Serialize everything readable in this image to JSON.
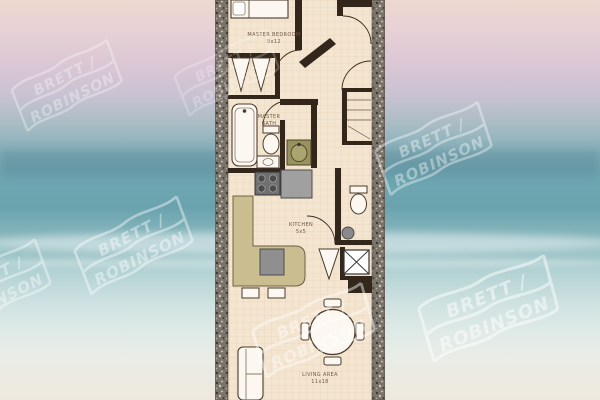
{
  "watermark": {
    "line1": "BRETT /",
    "line2": "ROBINSON",
    "color": "#ffffff"
  },
  "floor_plan": {
    "rooms": [
      {
        "name": "MASTER BEDROOM",
        "size": "9x12"
      },
      {
        "name": "MASTER BATH",
        "name_lines": [
          "MASTER",
          "BATH"
        ]
      },
      {
        "name": "KITCHEN",
        "size": "5x5"
      },
      {
        "name": "LIVING AREA",
        "size": "11x18"
      }
    ],
    "colors": {
      "floor": "#f4e5d0",
      "grid": "#e3cdb0",
      "interior_walls": "#33261b",
      "exterior_wall_speckle": "#7a736a",
      "counter": "#cabe90",
      "fixture_outline": "#4a3b2d",
      "label_text": "#6f5947"
    }
  },
  "background": {
    "scene_colors": {
      "sky_pink": "#ecd8cf",
      "sky_lavender": "#dbc7d5",
      "ocean_teal": "#6aa3ae",
      "foam_white": "#dfeae7",
      "sand": "#efe9dd"
    }
  }
}
